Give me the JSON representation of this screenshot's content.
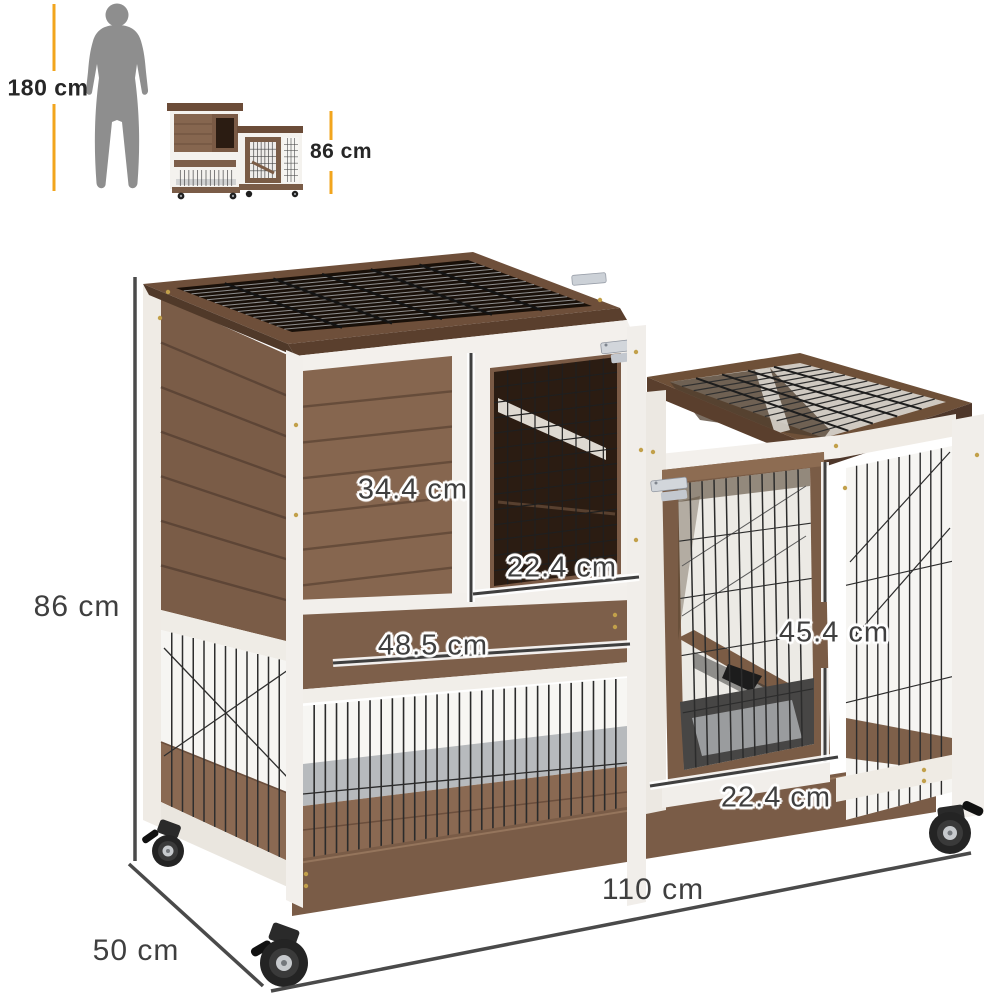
{
  "figure": {
    "type": "product-dimension-diagram",
    "subject": "two-tier wooden pet hutch on casters",
    "background": "#ffffff"
  },
  "scale_legend": {
    "human_height": "180 cm",
    "hutch_height": "86 cm"
  },
  "dimension_labels": {
    "overall_height": "86 cm",
    "overall_width": "110 cm",
    "overall_depth": "50 cm",
    "left_door_height": "34.4 cm",
    "left_door_width": "22.4 cm",
    "drawer_width": "48.5 cm",
    "right_door_height": "45.4 cm",
    "right_door_width": "22.4 cm"
  },
  "colors": {
    "accent_orange": "#F2A51D",
    "dimension_line": "#4A4A4A",
    "label_text": "#3F3F3F",
    "legend_text": "#262626",
    "wood_mid": "#86664F",
    "wood_dark": "#6E4F3A",
    "skirt_wood": "#7A5C47",
    "trim_white": "#F3F0EC",
    "mesh_wire": "#2C2C2C",
    "silhouette_gray": "#8E8E8E"
  }
}
